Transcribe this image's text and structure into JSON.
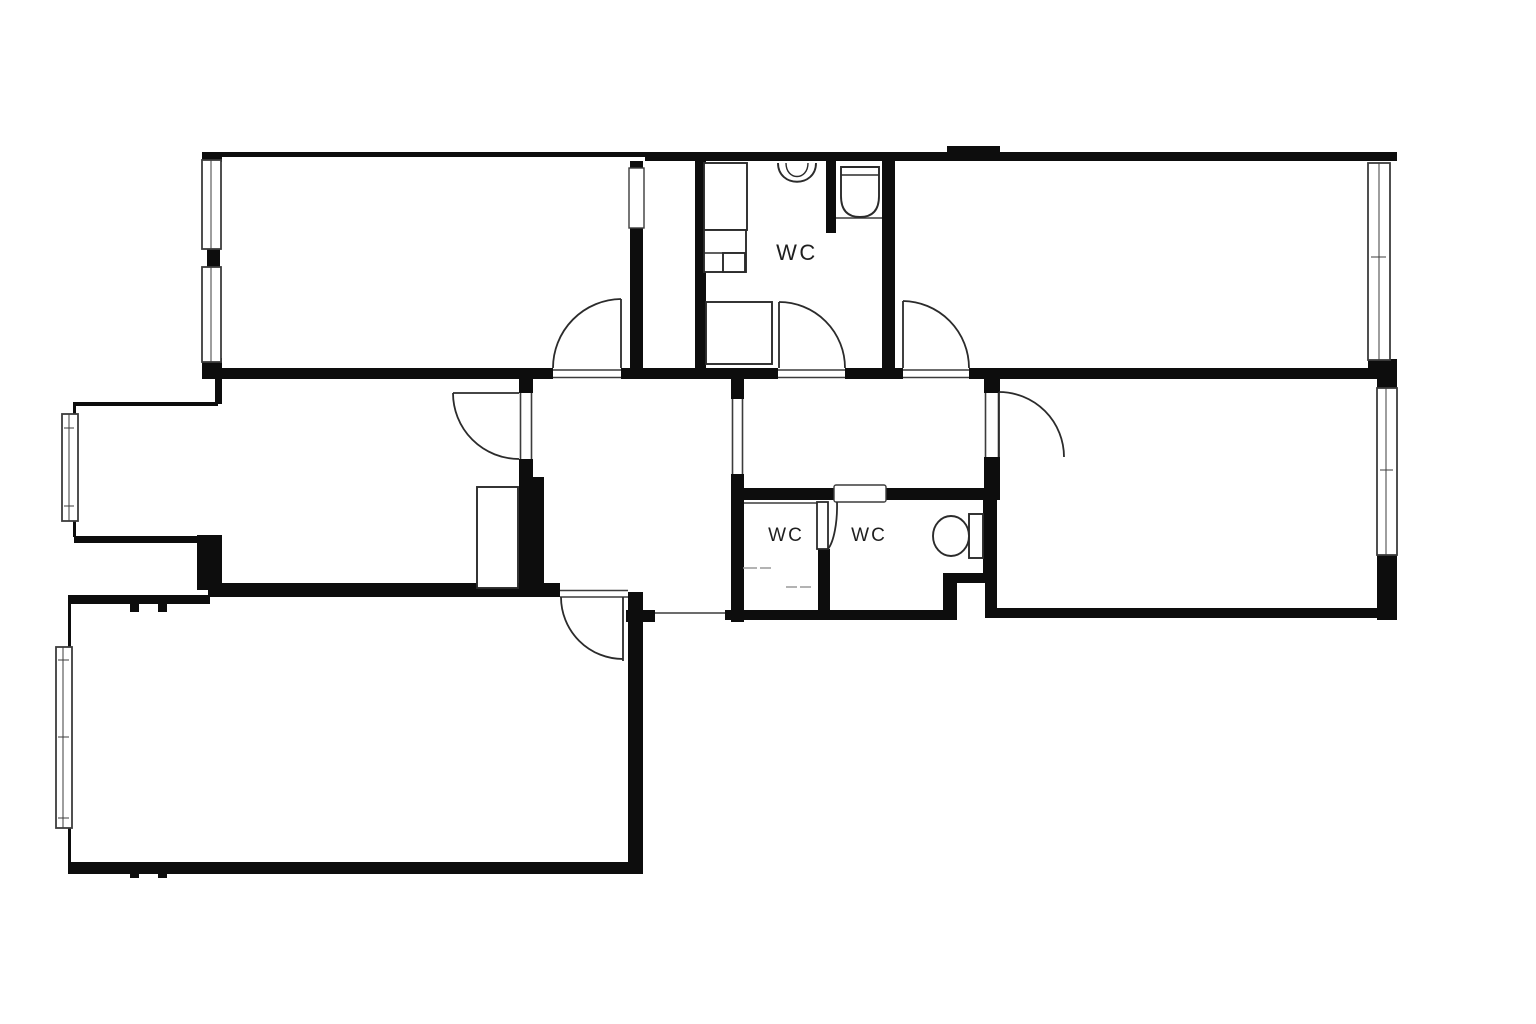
{
  "page": {
    "type": "architectural-floor-plan",
    "description": "black and white apartment floor plan drawing"
  },
  "colors": {
    "background": "#ffffff",
    "wall": "#0d0d0d",
    "line": "#3c3c3c",
    "door": "#2b2b2b",
    "light_line": "#9a9a9a",
    "text": "#1f1f1f"
  },
  "labels": {
    "bathroom_main": "WC",
    "wc_left": "WC",
    "wc_right": "WC"
  },
  "icons": {
    "toilet_main": "toilet-icon",
    "toilet_small": "toilet-icon",
    "sink": "sink-icon",
    "washer_counter": "counter-icon",
    "shower_tray": "shower-tray-icon",
    "wardrobe": "wardrobe-icon",
    "window": "window-icon",
    "door_swing": "door-swing-icon"
  }
}
